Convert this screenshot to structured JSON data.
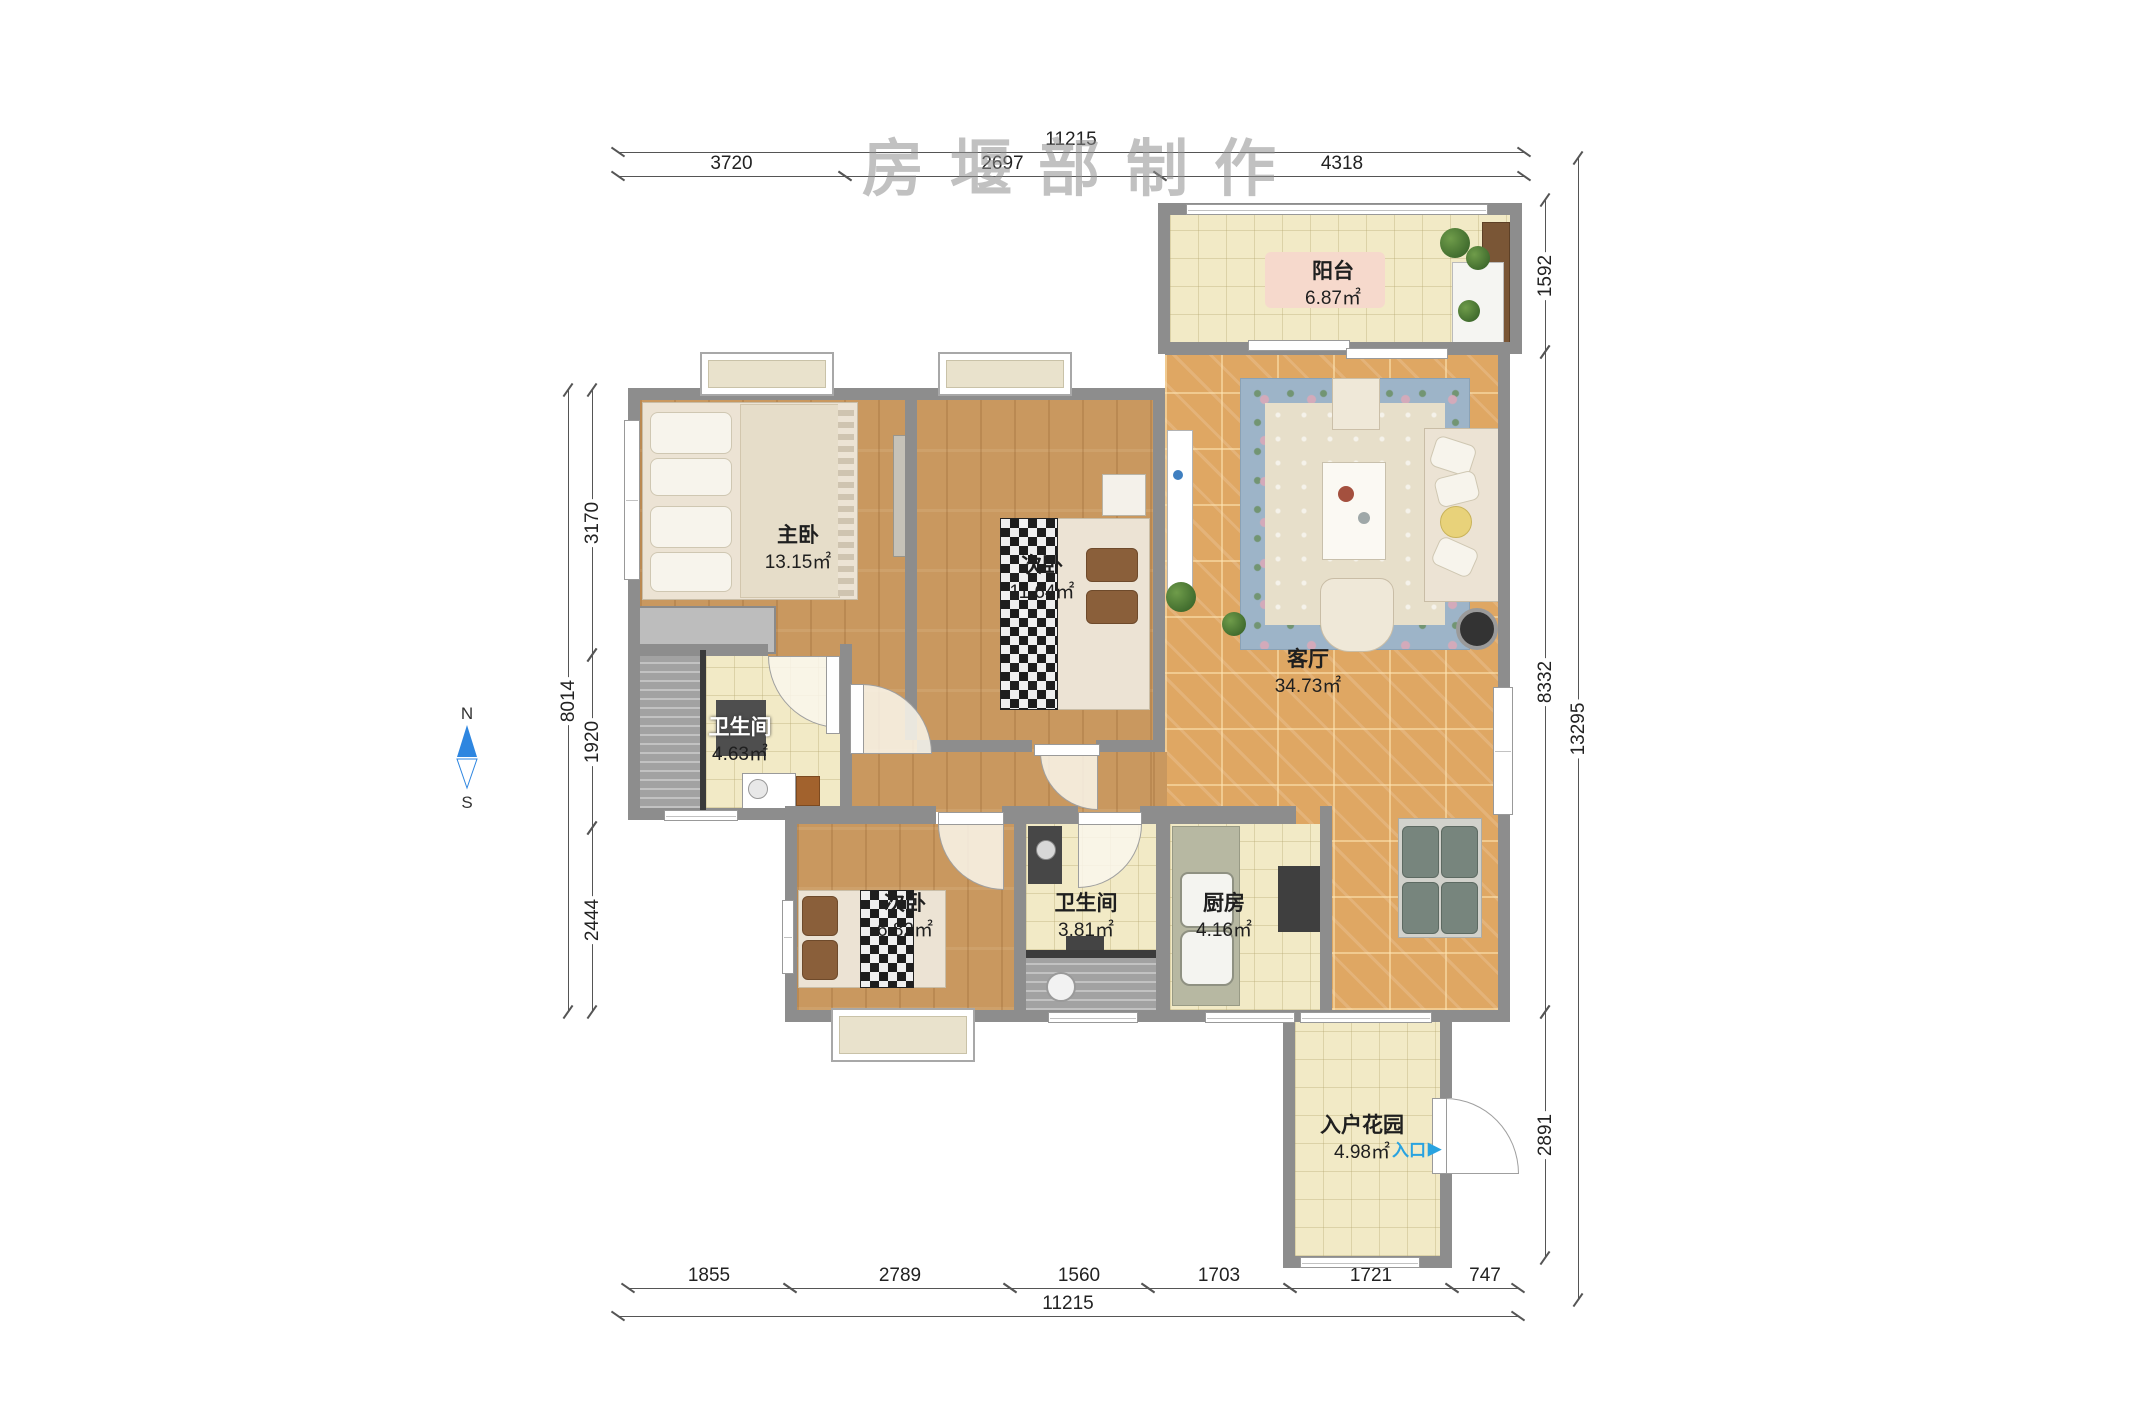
{
  "watermark": {
    "text": "房堰部制作"
  },
  "compass": {
    "north_label": "N",
    "south_label": "S"
  },
  "rooms": {
    "balcony": {
      "name": "阳台",
      "area": "6.87㎡"
    },
    "living_room": {
      "name": "客厅",
      "area": "34.73㎡"
    },
    "master_bedroom": {
      "name": "主卧",
      "area": "13.15㎡"
    },
    "bedroom2": {
      "name": "次卧",
      "area": "11.64㎡"
    },
    "bathroom1": {
      "name": "卫生间",
      "area": "4.63㎡"
    },
    "bedroom3": {
      "name": "次卧",
      "area": "6.82㎡"
    },
    "bathroom2": {
      "name": "卫生间",
      "area": "3.81㎡"
    },
    "kitchen": {
      "name": "厨房",
      "area": "4.16㎡"
    },
    "entry_garden": {
      "name": "入户花园",
      "area": "4.98㎡"
    }
  },
  "entrance": {
    "label": "入口",
    "arrow": "▶"
  },
  "dimensions": {
    "top": {
      "total": "11215",
      "segments": [
        "3720",
        "2697",
        "4318"
      ]
    },
    "bottom": {
      "total": "11215",
      "segments": [
        "1855",
        "2789",
        "1560",
        "1703",
        "1721",
        "747"
      ]
    },
    "left": {
      "total": "8014",
      "segments": [
        "3170",
        "1920",
        "2444"
      ]
    },
    "right": {
      "total": "13295",
      "segments": [
        "1592",
        "8332",
        "2891"
      ]
    }
  },
  "colors": {
    "entrance_accent": "#29a3e0",
    "compass_north": "#2e86e0",
    "wall": "#8d8d8d",
    "wood_floor": "#c9985f",
    "tile_living": "#dfa763",
    "tile_cream": "#f2eac6"
  }
}
